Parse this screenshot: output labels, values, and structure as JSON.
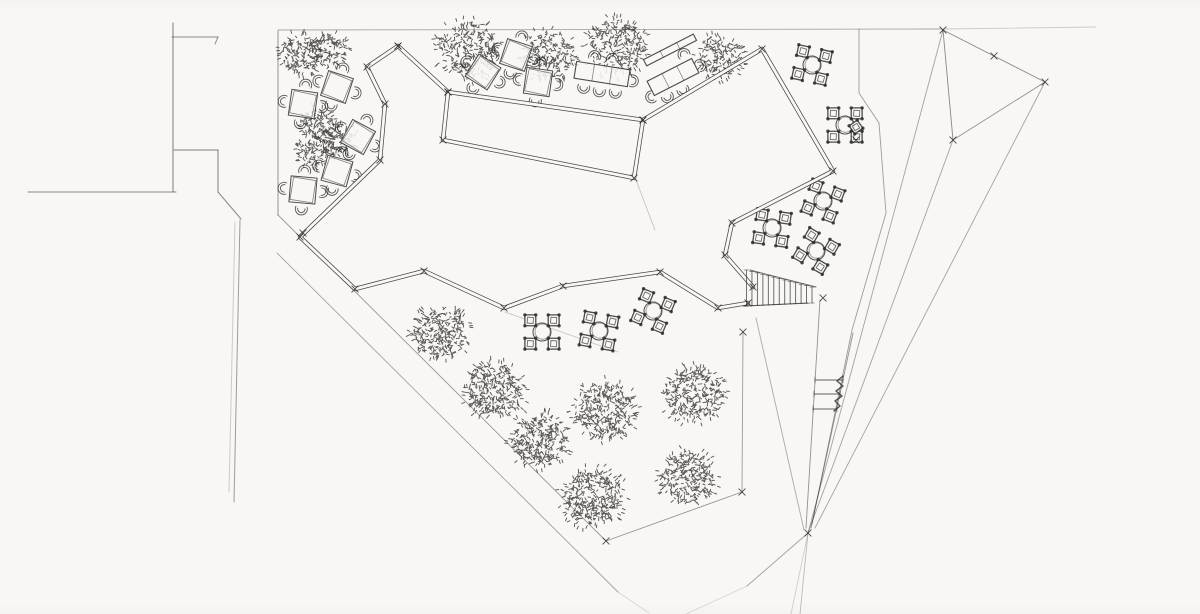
{
  "meta": {
    "title": "hand-drawn landscape site plan sketch",
    "type": "pencil-ink plan drawing, plaza with winding bench ribbon, trees, cafe tables, stairs and perspective construction lines"
  },
  "colors": {
    "paper": "#f8f7f4",
    "ink": "#2d2d2b",
    "faint": "#6f6f6c"
  },
  "street_lines": [
    {
      "pts": [
        [
          173,
          23
        ],
        [
          173,
          192
        ]
      ],
      "o": 0.6
    },
    {
      "pts": [
        [
          172,
          37
        ],
        [
          218,
          37
        ]
      ],
      "o": 0.55
    },
    {
      "pts": [
        [
          218,
          37
        ],
        [
          215,
          44
        ]
      ],
      "o": 0.5
    },
    {
      "pts": [
        [
          174,
          150
        ],
        [
          218,
          150
        ]
      ],
      "o": 0.6
    },
    {
      "pts": [
        [
          218,
          150
        ],
        [
          218,
          192
        ]
      ],
      "o": 0.6
    },
    {
      "pts": [
        [
          28,
          192
        ],
        [
          176,
          192
        ]
      ],
      "o": 0.55
    },
    {
      "pts": [
        [
          218,
          192
        ],
        [
          241,
          219
        ]
      ],
      "o": 0.55
    },
    {
      "pts": [
        [
          240,
          220
        ],
        [
          234,
          502
        ]
      ],
      "o": 0.45
    },
    {
      "pts": [
        [
          235,
          222
        ],
        [
          229,
          492
        ]
      ],
      "o": 0.22
    }
  ],
  "construction_lines": [
    {
      "pts": [
        [
          278,
          30
        ],
        [
          943,
          29
        ]
      ],
      "o": 0.4
    },
    {
      "pts": [
        [
          943,
          29
        ],
        [
          1096,
          27
        ]
      ],
      "o": 0.22
    },
    {
      "pts": [
        [
          278,
          31
        ],
        [
          278,
          215
        ]
      ],
      "o": 0.55
    },
    {
      "pts": [
        [
          278,
          215
        ],
        [
          606,
          541
        ]
      ],
      "o": 0.48
    },
    {
      "pts": [
        [
          277,
          253
        ],
        [
          618,
          592
        ]
      ],
      "o": 0.42
    },
    {
      "pts": [
        [
          618,
          592
        ],
        [
          649,
          613
        ]
      ],
      "o": 0.16
    },
    {
      "pts": [
        [
          606,
          541
        ],
        [
          742,
          492
        ]
      ],
      "o": 0.5
    },
    {
      "pts": [
        [
          742,
          492
        ],
        [
          743,
          332
        ]
      ],
      "o": 0.45
    },
    {
      "pts": [
        [
          505,
          312
        ],
        [
          618,
          352
        ]
      ],
      "o": 0.25
    },
    {
      "pts": [
        [
          859,
          29
        ],
        [
          859,
          93
        ],
        [
          879,
          123
        ],
        [
          886,
          213
        ],
        [
          852,
          330
        ],
        [
          812,
          524
        ]
      ],
      "o": 0.45
    },
    {
      "pts": [
        [
          943,
          30
        ],
        [
          1045,
          82
        ]
      ],
      "o": 0.55
    },
    {
      "pts": [
        [
          943,
          30
        ],
        [
          953,
          140
        ]
      ],
      "o": 0.55
    },
    {
      "pts": [
        [
          1045,
          82
        ],
        [
          953,
          140
        ]
      ],
      "o": 0.5
    },
    {
      "pts": [
        [
          943,
          30
        ],
        [
          808,
          533
        ]
      ],
      "o": 0.42
    },
    {
      "pts": [
        [
          953,
          140
        ],
        [
          808,
          533
        ]
      ],
      "o": 0.42
    },
    {
      "pts": [
        [
          1045,
          82
        ],
        [
          815,
          528
        ]
      ],
      "o": 0.42
    },
    {
      "pts": [
        [
          820,
          300
        ],
        [
          806,
          528
        ]
      ],
      "o": 0.5
    },
    {
      "pts": [
        [
          853,
          333
        ],
        [
          811,
          528
        ]
      ],
      "o": 0.5
    },
    {
      "pts": [
        [
          756,
          318
        ],
        [
          804,
          530
        ]
      ],
      "o": 0.38
    },
    {
      "pts": [
        [
          808,
          533
        ],
        [
          747,
          586
        ]
      ],
      "o": 0.42
    },
    {
      "pts": [
        [
          747,
          586
        ],
        [
          686,
          614
        ]
      ],
      "o": 0.16
    },
    {
      "pts": [
        [
          808,
          533
        ],
        [
          800,
          614
        ]
      ],
      "o": 0.3
    },
    {
      "pts": [
        [
          808,
          533
        ],
        [
          791,
          614
        ]
      ],
      "o": 0.2
    },
    {
      "pts": [
        [
          636,
          180
        ],
        [
          655,
          230
        ]
      ],
      "o": 0.25
    }
  ],
  "ribbon": {
    "upper_a": [
      [
        398,
        46
      ],
      [
        448,
        92
      ]
    ],
    "planter_rect": [
      [
        448,
        92
      ],
      [
        643,
        120
      ],
      [
        634,
        178
      ],
      [
        443,
        140
      ]
    ],
    "upper_b": [
      [
        643,
        120
      ],
      [
        762,
        49
      ],
      [
        833,
        171
      ],
      [
        732,
        223
      ],
      [
        725,
        255
      ],
      [
        753,
        287
      ]
    ],
    "lower": [
      [
        398,
        46
      ],
      [
        367,
        67
      ],
      [
        385,
        104
      ],
      [
        380,
        160
      ],
      [
        300,
        237
      ],
      [
        355,
        289
      ],
      [
        424,
        271
      ],
      [
        504,
        308
      ],
      [
        563,
        286
      ],
      [
        660,
        272
      ],
      [
        718,
        308
      ],
      [
        748,
        303
      ]
    ]
  },
  "stairs": {
    "top_edge": [
      [
        750,
        270
      ],
      [
        816,
        287
      ]
    ],
    "bottom_edge": [
      [
        743,
        306
      ],
      [
        808,
        303
      ]
    ],
    "rungs": 13
  },
  "ladder": {
    "rungs": [
      [
        [
          815,
          380
        ],
        [
          843,
          380
        ]
      ],
      [
        [
          814,
          394
        ],
        [
          840,
          394
        ]
      ],
      [
        [
          813,
          409
        ],
        [
          837,
          409
        ]
      ]
    ],
    "squiggle": [
      [
        843,
        376
      ],
      [
        837,
        381
      ],
      [
        843,
        386
      ],
      [
        836,
        391
      ],
      [
        842,
        396
      ],
      [
        835,
        401
      ],
      [
        840,
        406
      ],
      [
        834,
        411
      ]
    ]
  },
  "trees": [
    {
      "x": 301,
      "y": 54,
      "r": 20,
      "d": 0.62
    },
    {
      "x": 331,
      "y": 49,
      "r": 16,
      "d": 0.6
    },
    {
      "x": 316,
      "y": 124,
      "r": 16,
      "d": 0.62
    },
    {
      "x": 337,
      "y": 141,
      "r": 17,
      "d": 0.62
    },
    {
      "x": 313,
      "y": 153,
      "r": 14,
      "d": 0.6
    },
    {
      "x": 468,
      "y": 50,
      "r": 29,
      "d": 0.5
    },
    {
      "x": 549,
      "y": 55,
      "r": 25,
      "d": 0.5
    },
    {
      "x": 617,
      "y": 47,
      "r": 28,
      "d": 0.5
    },
    {
      "x": 719,
      "y": 57,
      "r": 22,
      "d": 0.52
    },
    {
      "x": 440,
      "y": 333,
      "r": 26,
      "d": 0.6
    },
    {
      "x": 494,
      "y": 390,
      "r": 28,
      "d": 0.62
    },
    {
      "x": 540,
      "y": 440,
      "r": 27,
      "d": 0.62
    },
    {
      "x": 605,
      "y": 411,
      "r": 29,
      "d": 0.6
    },
    {
      "x": 694,
      "y": 394,
      "r": 28,
      "d": 0.6
    },
    {
      "x": 688,
      "y": 477,
      "r": 26,
      "d": 0.62
    },
    {
      "x": 593,
      "y": 497,
      "r": 29,
      "d": 0.62
    }
  ],
  "square_tables": [
    {
      "x": 337,
      "y": 87,
      "rot": 18
    },
    {
      "x": 303,
      "y": 104,
      "rot": 8
    },
    {
      "x": 358,
      "y": 137,
      "rot": 28
    },
    {
      "x": 337,
      "y": 171,
      "rot": 15
    },
    {
      "x": 303,
      "y": 190,
      "rot": 5
    },
    {
      "x": 483,
      "y": 72,
      "rot": 32
    },
    {
      "x": 516,
      "y": 55,
      "rot": 18
    },
    {
      "x": 538,
      "y": 82,
      "rot": 8
    }
  ],
  "round_tables": [
    {
      "x": 812,
      "y": 65,
      "rot": 12
    },
    {
      "x": 845,
      "y": 125,
      "rot": 0
    },
    {
      "x": 823,
      "y": 201,
      "rot": 20
    },
    {
      "x": 772,
      "y": 228,
      "rot": 8
    },
    {
      "x": 816,
      "y": 251,
      "rot": 30
    },
    {
      "x": 542,
      "y": 332,
      "rot": 0
    },
    {
      "x": 599,
      "y": 331,
      "rot": 10
    },
    {
      "x": 653,
      "y": 311,
      "rot": 22
    }
  ],
  "long_tables": [
    {
      "x": 602,
      "y": 74,
      "w": 54,
      "h": 17,
      "rot": 9,
      "chairs": [
        [
          -16,
          16,
          90
        ],
        [
          0,
          17,
          90
        ],
        [
          16,
          16,
          90
        ],
        [
          -10,
          -16,
          270
        ],
        [
          8,
          -16,
          270
        ],
        [
          31,
          2,
          0
        ]
      ]
    },
    {
      "x": 670,
      "y": 50,
      "w": 56,
      "h": 7,
      "rot": -27,
      "chairs": []
    },
    {
      "x": 673,
      "y": 77,
      "w": 50,
      "h": 16,
      "rot": -27,
      "chairs": [
        [
          -14,
          15,
          90
        ],
        [
          3,
          16,
          90
        ],
        [
          29,
          2,
          0
        ],
        [
          20,
          -15,
          270
        ],
        [
          -28,
          8,
          180
        ]
      ]
    }
  ],
  "single_diamonds": [
    {
      "x": 856,
      "y": 127,
      "s": 10,
      "rot": 10
    }
  ],
  "extra_xmarks": [
    [
      994,
      56
    ],
    [
      1045,
      82
    ],
    [
      953,
      140
    ],
    [
      943,
      30
    ],
    [
      808,
      533
    ],
    [
      606,
      541
    ],
    [
      742,
      492
    ],
    [
      743,
      332
    ],
    [
      823,
      298
    ],
    [
      303,
      233
    ],
    [
      856,
      140
    ]
  ]
}
